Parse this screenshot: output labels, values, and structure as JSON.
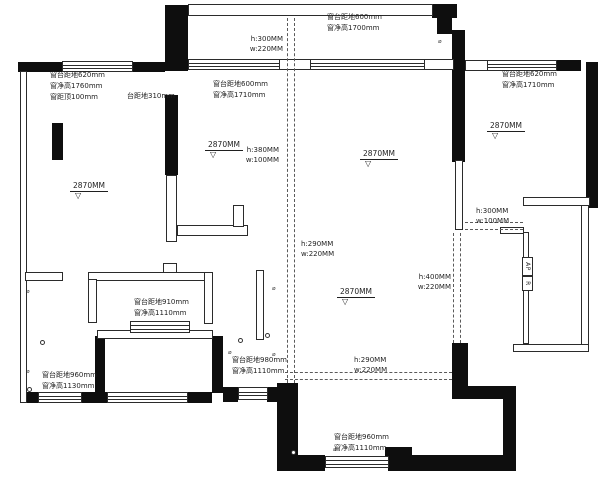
{
  "plan_title": "residential floor plan",
  "colors": {
    "background": "#ffffff",
    "wall_fill": "#0e0e0e",
    "line": "#2b2b2b",
    "beam_dash": "#5a5a5a",
    "text": "#1f1f1f"
  },
  "annotations": {
    "window_labels": [
      {
        "x": 50,
        "y": 70,
        "lines": [
          "窗台距地620mm",
          "窗净高1760mm",
          "窗距顶100mm"
        ]
      },
      {
        "x": 127,
        "y": 91,
        "lines": [
          "台距地310mm"
        ]
      },
      {
        "x": 213,
        "y": 79,
        "lines": [
          "窗台距地600mm",
          "窗净高1710mm"
        ]
      },
      {
        "x": 327,
        "y": 12,
        "lines": [
          "窗台距地600mm",
          "窗净高1700mm"
        ]
      },
      {
        "x": 502,
        "y": 69,
        "lines": [
          "窗台距地620mm",
          "窗净高1710mm"
        ]
      },
      {
        "x": 134,
        "y": 297,
        "lines": [
          "窗台距地910mm",
          "窗净高1110mm"
        ]
      },
      {
        "x": 42,
        "y": 370,
        "lines": [
          "窗台距地960mm",
          "窗净高1130mm"
        ]
      },
      {
        "x": 232,
        "y": 355,
        "lines": [
          "窗台距地980mm",
          "窗净高1110mm"
        ]
      },
      {
        "x": 334,
        "y": 432,
        "lines": [
          "窗台距地960mm",
          "窗净高1110mm"
        ]
      }
    ],
    "beam_labels": [
      {
        "x": 283,
        "y": 35,
        "align": "right",
        "lines": [
          "h:300MM",
          "w:220MM"
        ]
      },
      {
        "x": 279,
        "y": 146,
        "align": "right",
        "lines": [
          "h:380MM",
          "w:100MM"
        ]
      },
      {
        "x": 301,
        "y": 240,
        "align": "left",
        "lines": [
          "h:290MM",
          "w:220MM"
        ]
      },
      {
        "x": 354,
        "y": 356,
        "align": "left",
        "lines": [
          "h:290MM",
          "w:220MM"
        ]
      },
      {
        "x": 476,
        "y": 207,
        "align": "left",
        "lines": [
          "h:300MM",
          "w:100MM"
        ]
      },
      {
        "x": 451,
        "y": 273,
        "align": "right",
        "lines": [
          "h:400MM",
          "w:220MM"
        ]
      }
    ],
    "levels": [
      {
        "x": 70,
        "y": 182,
        "text": "2870MM"
      },
      {
        "x": 205,
        "y": 141,
        "text": "2870MM"
      },
      {
        "x": 360,
        "y": 150,
        "text": "2870MM"
      },
      {
        "x": 337,
        "y": 288,
        "text": "2870MM"
      },
      {
        "x": 487,
        "y": 122,
        "text": "2870MM"
      }
    ],
    "level_triangle_glyph": "▽",
    "marker_glyph_char": "⌀",
    "ac_platform": [
      {
        "x": 522,
        "y": 257,
        "w": 11,
        "h": 19,
        "label": "AP"
      },
      {
        "x": 522,
        "y": 276,
        "w": 11,
        "h": 15,
        "label": "R"
      }
    ]
  },
  "geometry": {
    "solid_walls": [
      [
        18,
        62,
        44,
        10
      ],
      [
        133,
        62,
        32,
        10
      ],
      [
        165,
        5,
        23,
        66
      ],
      [
        432,
        4,
        25,
        14
      ],
      [
        437,
        8,
        15,
        26
      ],
      [
        452,
        30,
        13,
        132
      ],
      [
        557,
        60,
        24,
        11
      ],
      [
        586,
        62,
        12,
        146
      ],
      [
        52,
        123,
        11,
        37
      ],
      [
        20,
        373,
        7,
        30
      ],
      [
        27,
        392,
        11,
        11
      ],
      [
        82,
        392,
        25,
        11
      ],
      [
        188,
        392,
        24,
        11
      ],
      [
        95,
        336,
        10,
        57
      ],
      [
        212,
        336,
        11,
        57
      ],
      [
        223,
        387,
        15,
        15
      ],
      [
        267,
        387,
        13,
        15
      ],
      [
        277,
        383,
        21,
        88
      ],
      [
        298,
        455,
        27,
        16
      ],
      [
        385,
        447,
        27,
        12
      ],
      [
        388,
        455,
        115,
        16
      ],
      [
        452,
        343,
        16,
        47
      ],
      [
        452,
        386,
        51,
        13
      ],
      [
        503,
        386,
        13,
        85
      ],
      [
        165,
        95,
        13,
        80
      ]
    ],
    "thin_walls": [
      [
        20,
        71,
        7,
        332
      ],
      [
        188,
        4,
        245,
        12
      ],
      [
        278,
        59,
        34,
        11
      ],
      [
        423,
        59,
        31,
        11
      ],
      [
        465,
        60,
        23,
        11
      ],
      [
        455,
        160,
        8,
        70
      ],
      [
        500,
        227,
        24,
        7
      ],
      [
        523,
        197,
        67,
        9
      ],
      [
        581,
        205,
        8,
        140
      ],
      [
        513,
        344,
        76,
        8
      ],
      [
        523,
        232,
        6,
        112
      ],
      [
        166,
        175,
        11,
        67
      ],
      [
        177,
        225,
        71,
        11
      ],
      [
        233,
        205,
        11,
        22
      ],
      [
        25,
        272,
        38,
        9
      ],
      [
        88,
        272,
        125,
        9
      ],
      [
        88,
        279,
        9,
        44
      ],
      [
        204,
        272,
        9,
        52
      ],
      [
        163,
        263,
        14,
        10
      ],
      [
        97,
        330,
        116,
        9
      ],
      [
        256,
        270,
        8,
        70
      ]
    ],
    "windows": [
      [
        62,
        61,
        71,
        11
      ],
      [
        188,
        59,
        92,
        11
      ],
      [
        310,
        59,
        115,
        11
      ],
      [
        487,
        60,
        70,
        11
      ],
      [
        38,
        392,
        44,
        11
      ],
      [
        107,
        392,
        81,
        11
      ],
      [
        130,
        321,
        60,
        12
      ],
      [
        238,
        387,
        30,
        13
      ],
      [
        325,
        456,
        64,
        12
      ]
    ],
    "beam_dashes": [
      {
        "x": 287,
        "y": 18,
        "len": 365,
        "dir": "v"
      },
      {
        "x": 294,
        "y": 18,
        "len": 365,
        "dir": "v"
      },
      {
        "x": 285,
        "y": 372,
        "len": 167,
        "dir": "h"
      },
      {
        "x": 285,
        "y": 379,
        "len": 167,
        "dir": "h"
      },
      {
        "x": 465,
        "y": 222,
        "len": 58,
        "dir": "h"
      },
      {
        "x": 465,
        "y": 229,
        "len": 58,
        "dir": "h"
      },
      {
        "x": 453,
        "y": 233,
        "len": 110,
        "dir": "v"
      },
      {
        "x": 460,
        "y": 233,
        "len": 110,
        "dir": "v"
      }
    ],
    "marker_circles": [
      [
        40,
        340
      ],
      [
        27,
        387
      ],
      [
        265,
        333
      ],
      [
        238,
        338
      ],
      [
        291,
        450
      ]
    ],
    "marker_glyphs": [
      [
        26,
        289
      ],
      [
        26,
        369
      ],
      [
        228,
        350
      ],
      [
        272,
        286
      ],
      [
        272,
        352
      ],
      [
        333,
        447
      ],
      [
        438,
        39
      ]
    ]
  }
}
